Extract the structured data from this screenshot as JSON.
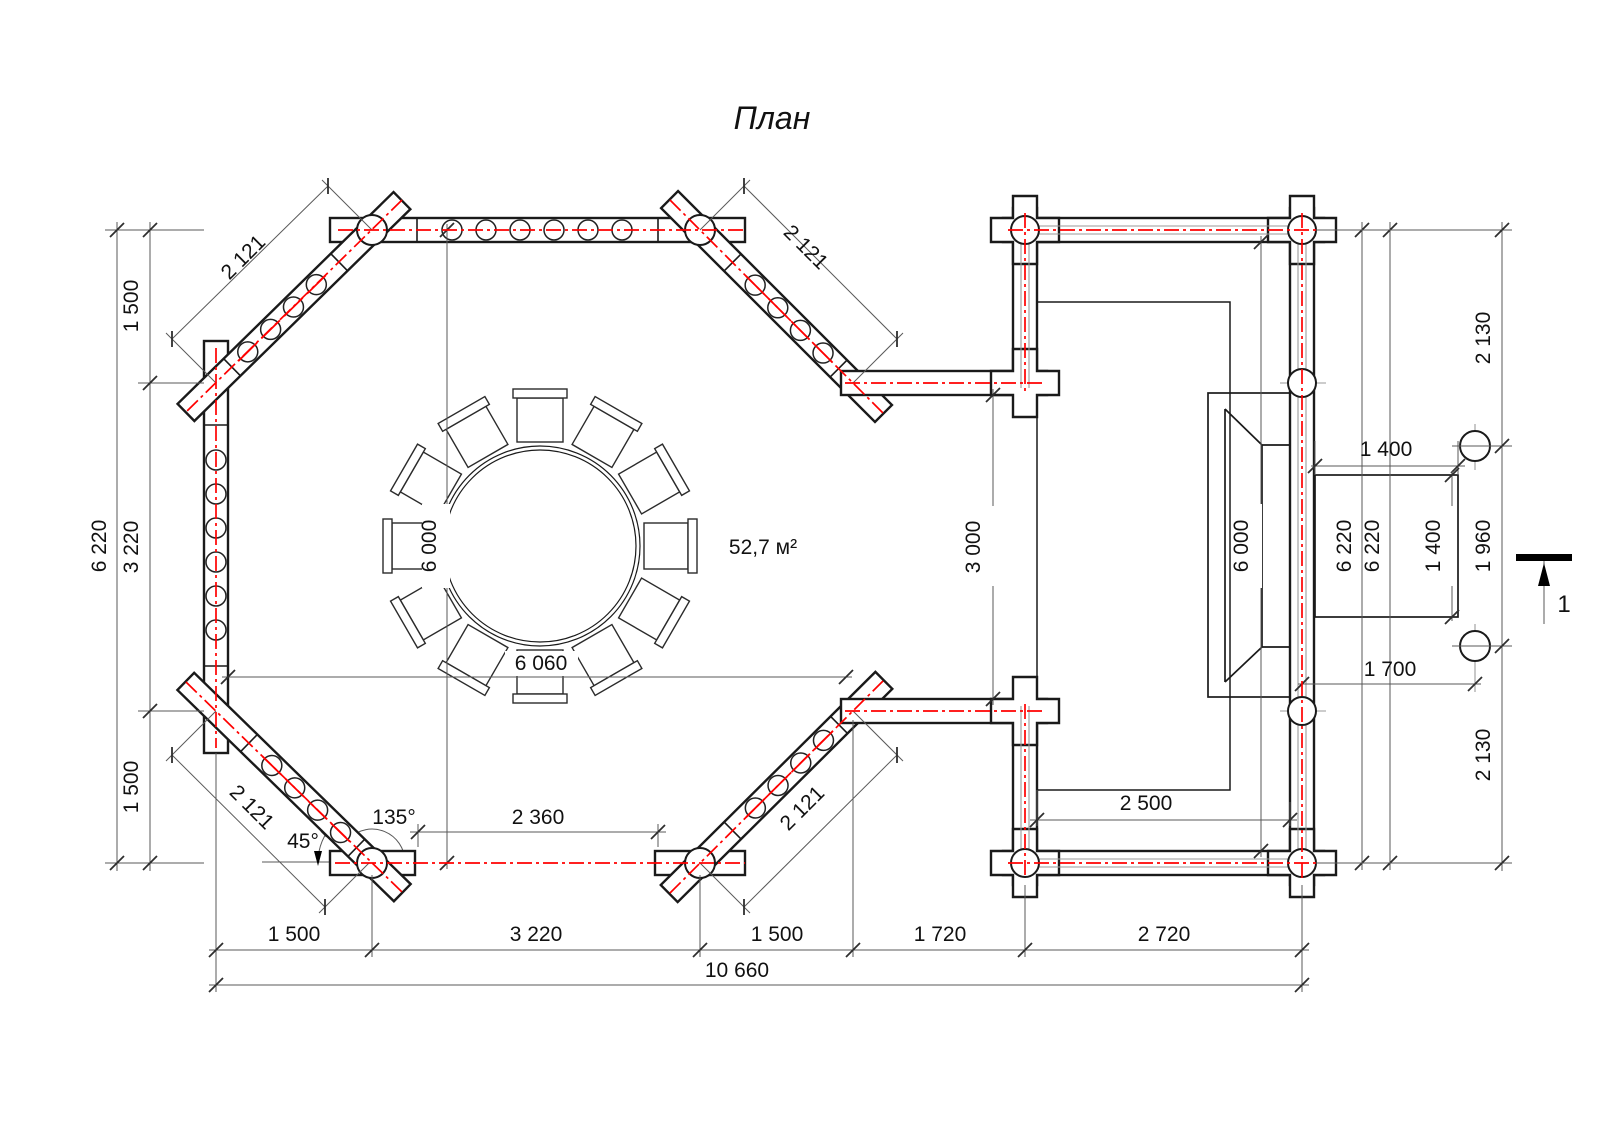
{
  "title": "План",
  "area_label": "52,7 м²",
  "colors": {
    "centerline": "#ff0000",
    "walls": "#1a1a1a",
    "dimensions": "#595959"
  },
  "angles": {
    "interior": "135°",
    "half": "45°"
  },
  "section": {
    "label": "1"
  },
  "dimensions": {
    "tl_diag": "2 121",
    "tr_diag": "2 121",
    "bl_diag": "2 121",
    "br_diag": "2 121",
    "left_total": "6 220",
    "left_seg": [
      "1 500",
      "3 220",
      "1 500"
    ],
    "bottom_seg": [
      "1 500",
      "3 220",
      "1 500",
      "1 720",
      "2 720"
    ],
    "bottom_total": "10 660",
    "entrance": "2 360",
    "hall_width": "6 060",
    "hall_height": "6 000",
    "right_opening": "3 000",
    "terrace_height": "6 000",
    "right_total_a": "6 220",
    "right_total_b": "6 220",
    "landing_width": "1 400",
    "landing_depth": "1 400",
    "right_seg": [
      "2 130",
      "1 960",
      "2 130"
    ],
    "post_offset": "1 700",
    "terrace_clear": "2 500"
  }
}
